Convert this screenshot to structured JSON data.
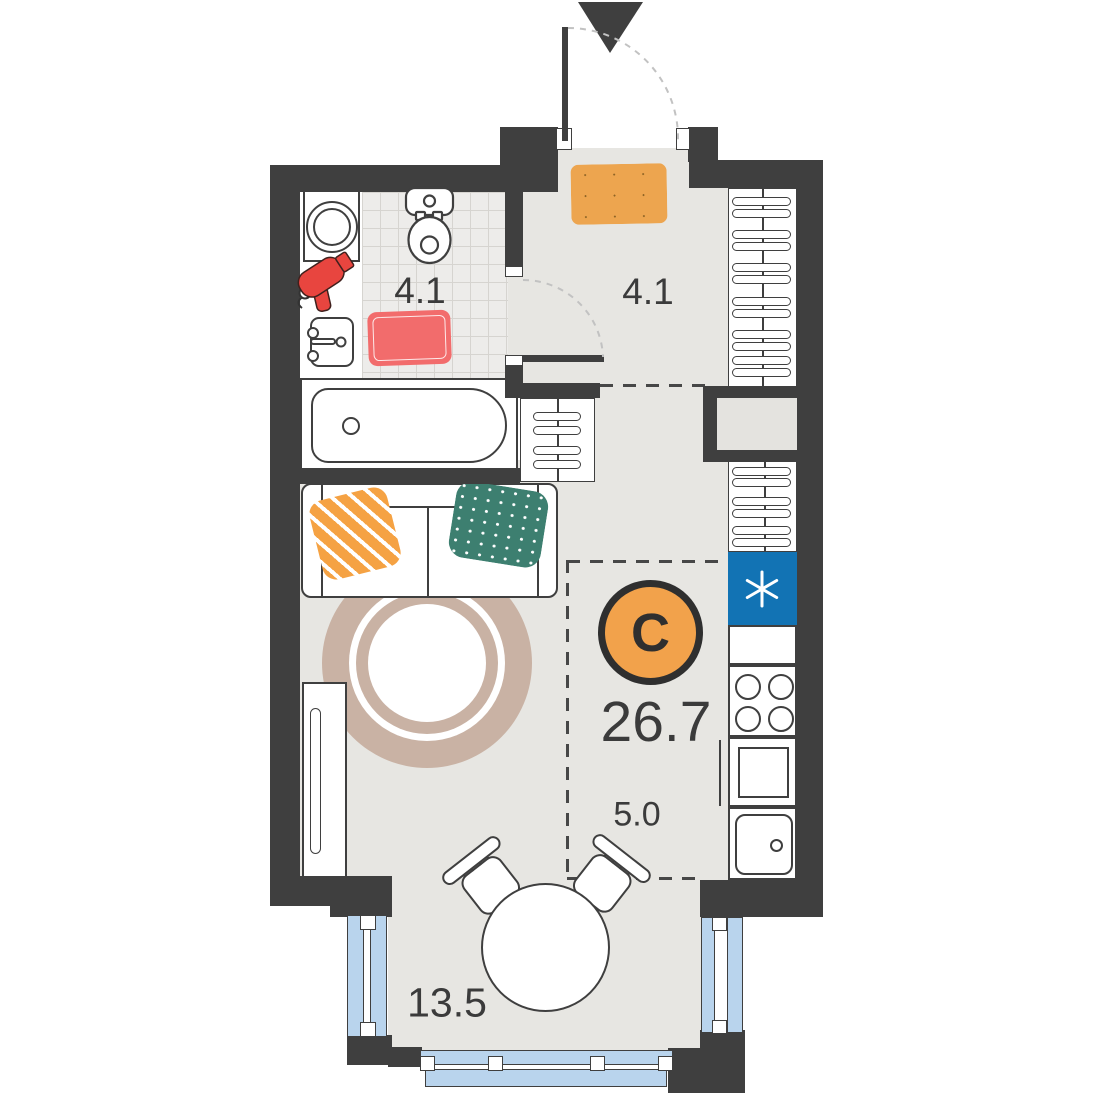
{
  "plan": {
    "studio_label": "С",
    "total_area": "26.7",
    "bathroom_area": "4.1",
    "hallway_area": "4.1",
    "kitchen_area": "5.0",
    "living_area": "13.5"
  },
  "fixtures": [
    "entrance-arrow-icon",
    "entry-door-icon",
    "doormat-icon",
    "washing-machine-icon",
    "hair-dryer-icon",
    "bathroom-sink-icon",
    "toilet-icon",
    "bath-mat-icon",
    "bathtub-icon",
    "interior-door-icon",
    "wardrobe-hangers-icon",
    "ventilation-shaft",
    "refrigerator-icon",
    "refrigerator-snowflake-icon",
    "stove-icon",
    "kitchen-counter-icon",
    "kitchen-sink-icon",
    "sofa-icon",
    "pillow-icon",
    "rug-icon",
    "cabinet-icon",
    "dining-table-icon",
    "chair-icon",
    "window-icon"
  ],
  "colors": {
    "wall": "#3f3f3f",
    "outline": "#3f3f3f",
    "floor": "#e7e6e2",
    "tile_bg": "#edecea",
    "tile_line": "#d6d4d0",
    "shaft_floor": "#e4e3df",
    "window_blue": "#b9d4ed",
    "fridge_blue": "#1273b4",
    "accent_orange": "#f2a24b",
    "doormat_orange": "#eda54f",
    "mat_red": "#f26c6c",
    "dryer_red": "#e8453f",
    "pillow_orange": "#f5a243",
    "pillow_teal": "#3d7f70",
    "rug_tan": "#c9b2a4",
    "label": "#3b3b3b",
    "dash": "#474747",
    "arc": "#c2c2c2"
  }
}
